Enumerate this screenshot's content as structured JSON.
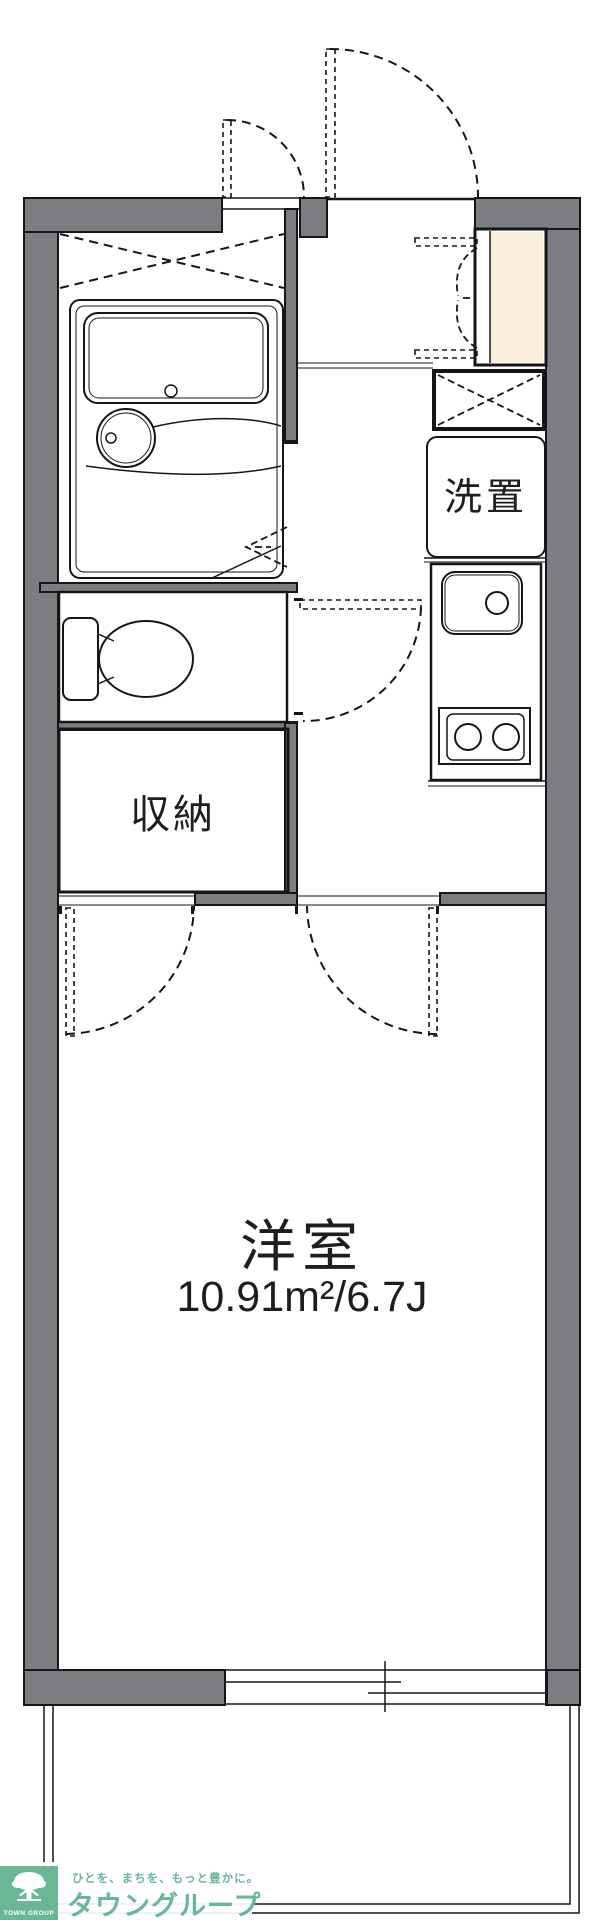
{
  "plan": {
    "western_room": {
      "label": "洋室",
      "area": "10.91m²/6.7J"
    },
    "closet": {
      "label": "収納"
    },
    "laundry": {
      "label": "洗置"
    }
  },
  "footer": {
    "mark_text": "TOWN GROUP",
    "tagline": "ひとを、まちを、もっと豊かに。",
    "brand": "タウングループ"
  },
  "colors": {
    "wall": "#7c7d80",
    "line": "#161616",
    "room_blue": "#d9e5f7",
    "fixture_blue": "#e3ecfa",
    "cream": "#faf0da",
    "text": "#1e1e1e",
    "brand_green": "#69b795",
    "bg": "#ffffff"
  }
}
